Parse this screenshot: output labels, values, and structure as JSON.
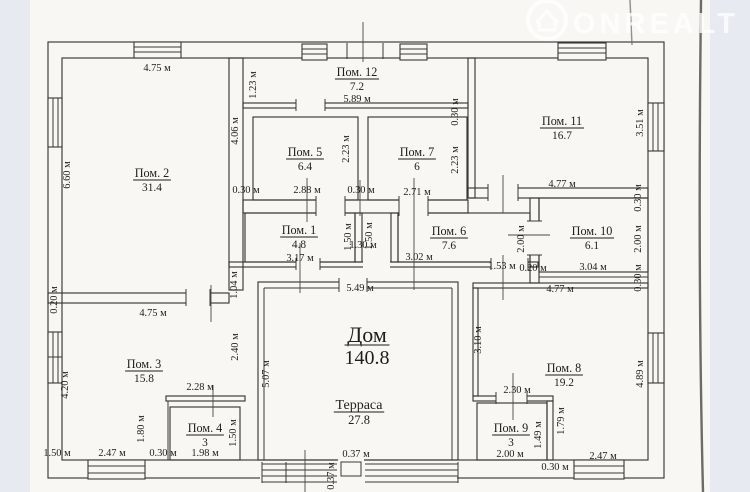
{
  "watermark": {
    "text": "ONREALT",
    "icon": "house-circle-icon",
    "color": "#ffffff"
  },
  "plan": {
    "unit": "м",
    "rooms": [
      {
        "label": "Пом. 2",
        "area": "31.4",
        "x": 152,
        "y": 177,
        "size": "sm"
      },
      {
        "label": "Пом. 12",
        "area": "7.2",
        "x": 357,
        "y": 76,
        "size": "sm"
      },
      {
        "label": "Пом. 5",
        "area": "6.4",
        "x": 305,
        "y": 156,
        "size": "sm"
      },
      {
        "label": "Пом. 7",
        "area": "6",
        "x": 417,
        "y": 156,
        "size": "sm"
      },
      {
        "label": "Пом. 11",
        "area": "16.7",
        "x": 562,
        "y": 125,
        "size": "sm"
      },
      {
        "label": "Пом. 1",
        "area": "4.8",
        "x": 299,
        "y": 234,
        "size": "sm"
      },
      {
        "label": "Пом. 6",
        "area": "7.6",
        "x": 449,
        "y": 235,
        "size": "sm"
      },
      {
        "label": "Пом. 10",
        "area": "6.1",
        "x": 592,
        "y": 235,
        "size": "sm"
      },
      {
        "label": "Пом. 3",
        "area": "15.8",
        "x": 144,
        "y": 368,
        "size": "sm"
      },
      {
        "label": "Пом. 4",
        "area": "3",
        "x": 205,
        "y": 432,
        "size": "sm"
      },
      {
        "label": "Пом. 8",
        "area": "19.2",
        "x": 564,
        "y": 372,
        "size": "sm"
      },
      {
        "label": "Пом. 9",
        "area": "3",
        "x": 511,
        "y": 432,
        "size": "sm"
      },
      {
        "label": "Дом",
        "area": "140.8",
        "x": 367,
        "y": 342,
        "size": "lg"
      },
      {
        "label": "Терраса",
        "area": "27.8",
        "x": 359,
        "y": 409,
        "size": "md"
      }
    ],
    "dims": [
      {
        "t": "4.75 м",
        "x": 157,
        "y": 71,
        "r": 0
      },
      {
        "t": "5.89 м",
        "x": 357,
        "y": 102,
        "r": 0
      },
      {
        "t": "0.30 м",
        "x": 246,
        "y": 193,
        "r": 0
      },
      {
        "t": "2.88 м",
        "x": 307,
        "y": 193,
        "r": 0
      },
      {
        "t": "0.30 м",
        "x": 361,
        "y": 193,
        "r": 0
      },
      {
        "t": "2.71 м",
        "x": 417,
        "y": 195,
        "r": 0
      },
      {
        "t": "4.77 м",
        "x": 562,
        "y": 187,
        "r": 0
      },
      {
        "t": "3.17 м",
        "x": 300,
        "y": 261,
        "r": 0
      },
      {
        "t": "1.30 м",
        "x": 363,
        "y": 248,
        "r": 0
      },
      {
        "t": "3.02 м",
        "x": 419,
        "y": 260,
        "r": 0
      },
      {
        "t": "1.53 м",
        "x": 502,
        "y": 269,
        "r": 0
      },
      {
        "t": "0.20 м",
        "x": 533,
        "y": 271,
        "r": 0
      },
      {
        "t": "3.04 м",
        "x": 593,
        "y": 270,
        "r": 0
      },
      {
        "t": "4.77 м",
        "x": 560,
        "y": 292,
        "r": 0
      },
      {
        "t": "5.49 м",
        "x": 360,
        "y": 291,
        "r": 0
      },
      {
        "t": "4.75 м",
        "x": 153,
        "y": 316,
        "r": 0
      },
      {
        "t": "2.28 м",
        "x": 200,
        "y": 390,
        "r": 0
      },
      {
        "t": "1.98 м",
        "x": 205,
        "y": 456,
        "r": 0
      },
      {
        "t": "0.30 м",
        "x": 163,
        "y": 456,
        "r": 0
      },
      {
        "t": "2.47 м",
        "x": 112,
        "y": 456,
        "r": 0
      },
      {
        "t": "1.50 м",
        "x": 57,
        "y": 456,
        "r": 0
      },
      {
        "t": "2.30 м",
        "x": 517,
        "y": 393,
        "r": 0
      },
      {
        "t": "2.00 м",
        "x": 510,
        "y": 457,
        "r": 0
      },
      {
        "t": "0.30 м",
        "x": 555,
        "y": 470,
        "r": 0
      },
      {
        "t": "2.47 м",
        "x": 603,
        "y": 459,
        "r": 0
      },
      {
        "t": "0.37 м",
        "x": 356,
        "y": 457,
        "r": 0
      },
      {
        "t": "6.60 м",
        "x": 70,
        "y": 175,
        "r": 1
      },
      {
        "t": "1.23 м",
        "x": 256,
        "y": 85,
        "r": 1
      },
      {
        "t": "4.06 м",
        "x": 238,
        "y": 131,
        "r": 1
      },
      {
        "t": "2.23 м",
        "x": 349,
        "y": 149,
        "r": 1
      },
      {
        "t": "0.30 м",
        "x": 458,
        "y": 112,
        "r": 1
      },
      {
        "t": "2.23 м",
        "x": 458,
        "y": 160,
        "r": 1
      },
      {
        "t": "3.51 м",
        "x": 643,
        "y": 123,
        "r": 1
      },
      {
        "t": "0.30 м",
        "x": 641,
        "y": 198,
        "r": 1
      },
      {
        "t": "2.00 м",
        "x": 641,
        "y": 239,
        "r": 1
      },
      {
        "t": "0.30 м",
        "x": 641,
        "y": 278,
        "r": 1
      },
      {
        "t": "2.00 м",
        "x": 524,
        "y": 239,
        "r": 1
      },
      {
        "t": "1.50 м",
        "x": 351,
        "y": 237,
        "r": 1
      },
      {
        "t": "1.50 м",
        "x": 372,
        "y": 236,
        "r": 1
      },
      {
        "t": "1.04 м",
        "x": 237,
        "y": 285,
        "r": 1
      },
      {
        "t": "0.20 м",
        "x": 57,
        "y": 300,
        "r": 1
      },
      {
        "t": "2.40 м",
        "x": 238,
        "y": 347,
        "r": 1
      },
      {
        "t": "4.20 м",
        "x": 68,
        "y": 385,
        "r": 1
      },
      {
        "t": "1.80 м",
        "x": 144,
        "y": 429,
        "r": 1
      },
      {
        "t": "1.50 м",
        "x": 236,
        "y": 433,
        "r": 1
      },
      {
        "t": "5.07 м",
        "x": 269,
        "y": 374,
        "r": 1
      },
      {
        "t": "3.10 м",
        "x": 481,
        "y": 340,
        "r": 1
      },
      {
        "t": "4.89 м",
        "x": 643,
        "y": 374,
        "r": 1
      },
      {
        "t": "1.49 м",
        "x": 541,
        "y": 435,
        "r": 1
      },
      {
        "t": "1.79 м",
        "x": 564,
        "y": 421,
        "r": 1
      },
      {
        "t": "0.37 м",
        "x": 334,
        "y": 476,
        "r": 1
      }
    ]
  }
}
